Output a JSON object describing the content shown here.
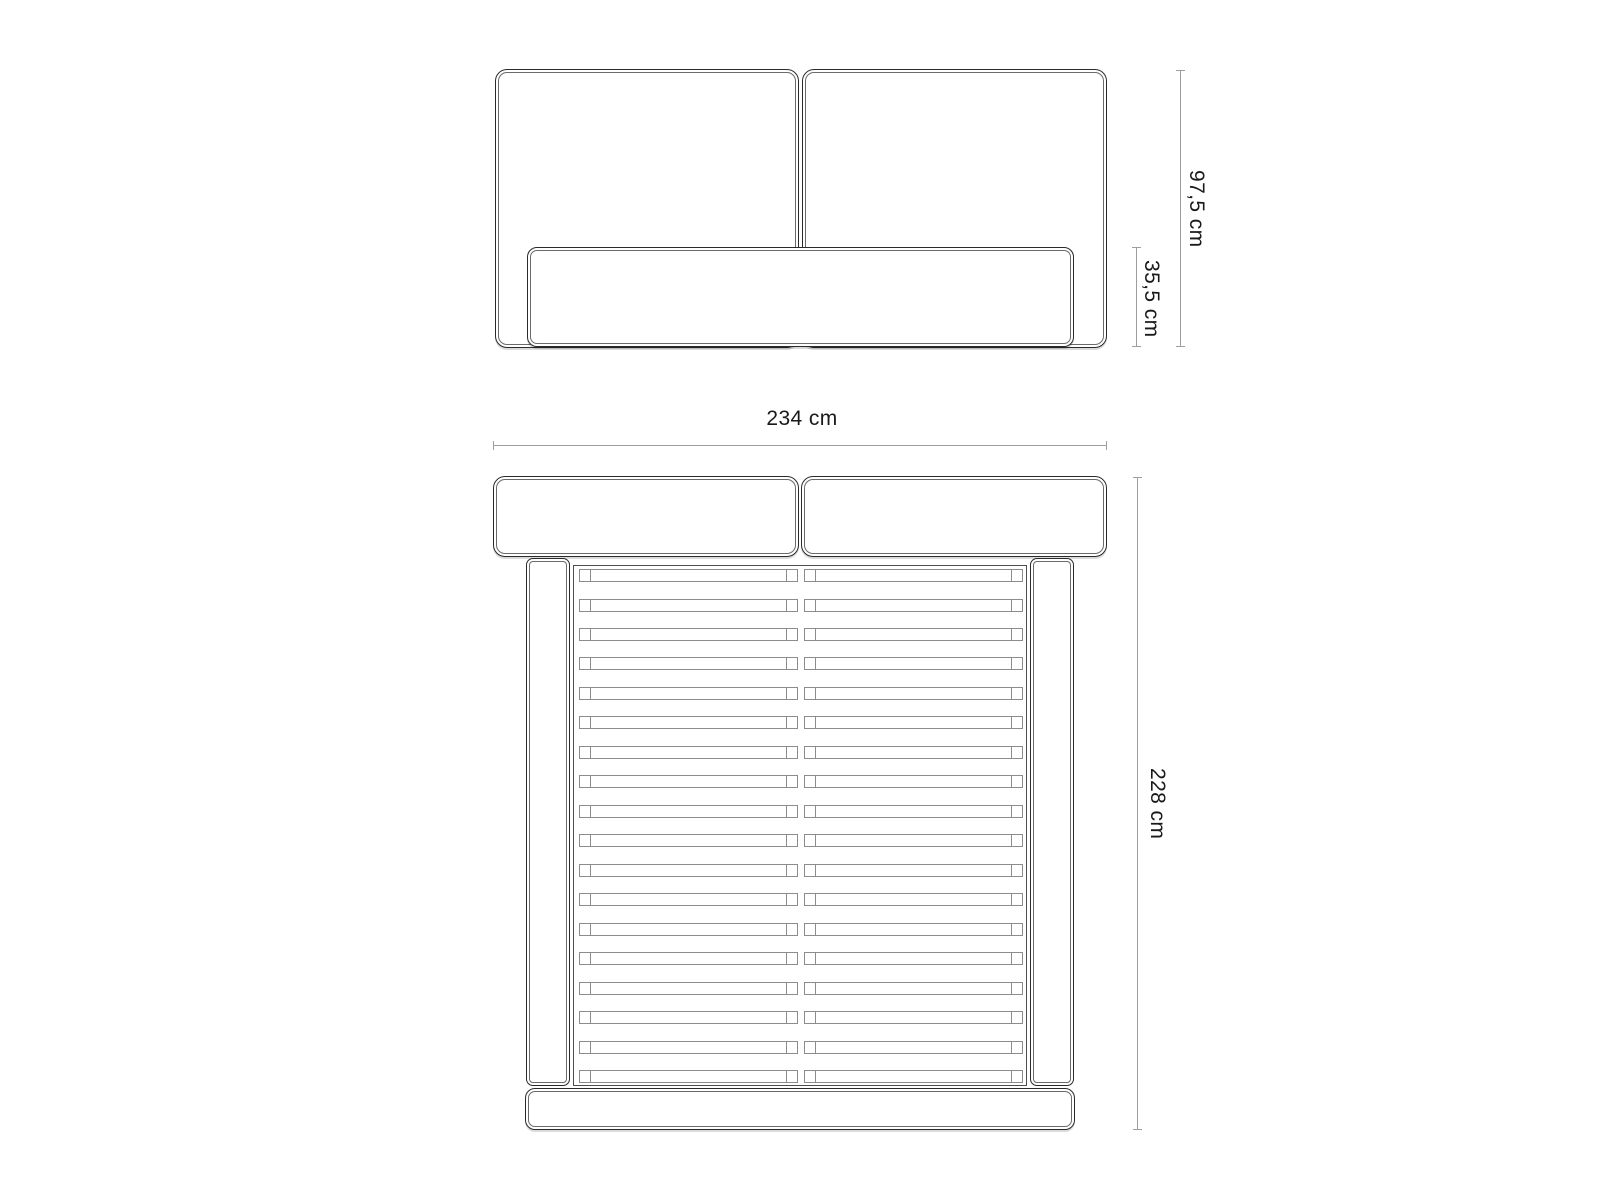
{
  "dims": {
    "total_height": "97,5 cm",
    "box_height": "35,5 cm",
    "width": "234 cm",
    "depth": "228 cm"
  },
  "plan_view": {
    "slat_rows": 18,
    "slats_per_row": 2
  },
  "colors": {
    "background": "#ffffff",
    "outline": "#2b2b2b",
    "slat_line": "#8c8c8c",
    "dim_line": "#9e9e9e",
    "text": "#1a1a1a"
  }
}
